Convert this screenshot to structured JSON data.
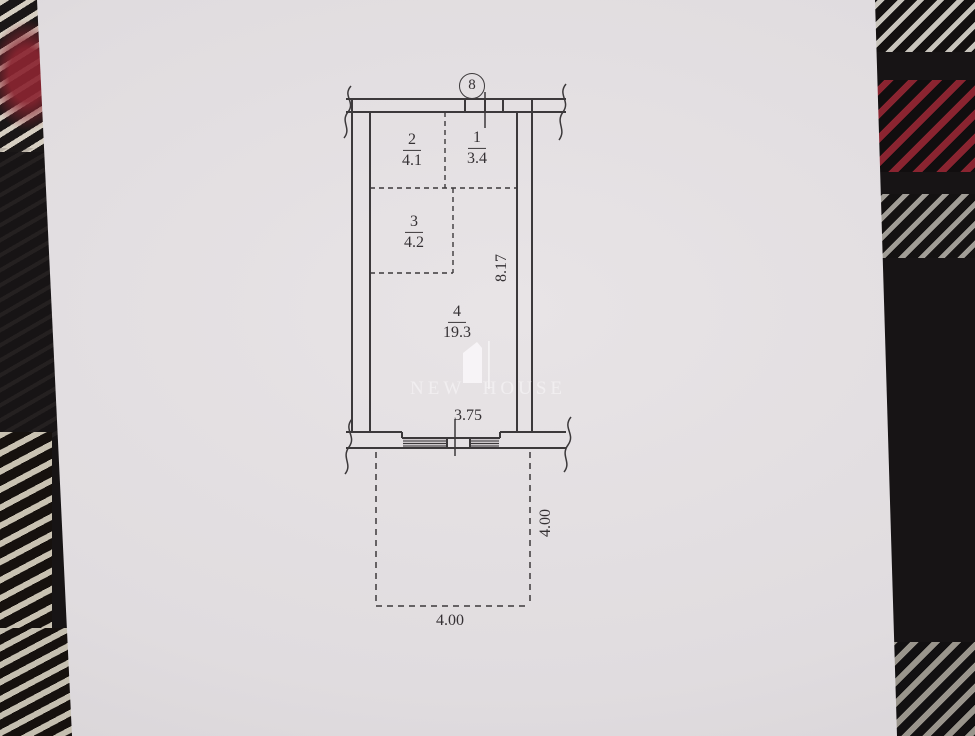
{
  "plan": {
    "unit_marker": "8",
    "rooms": [
      {
        "number": "1",
        "area": "3.4"
      },
      {
        "number": "2",
        "area": "4.1"
      },
      {
        "number": "3",
        "area": "4.2"
      },
      {
        "number": "4",
        "area": "19.3"
      }
    ],
    "dimensions": {
      "interior_height": "8.17",
      "window_width": "3.75",
      "balcony_depth": "4.00",
      "balcony_width": "4.00"
    },
    "watermark_text": "NEW HOUSE"
  },
  "colors": {
    "paper": "#e2dee1",
    "ink": "#3c393b",
    "fabric_black": "#171415",
    "fabric_red": "#8a2430",
    "fabric_cream": "#cfc9bc"
  }
}
